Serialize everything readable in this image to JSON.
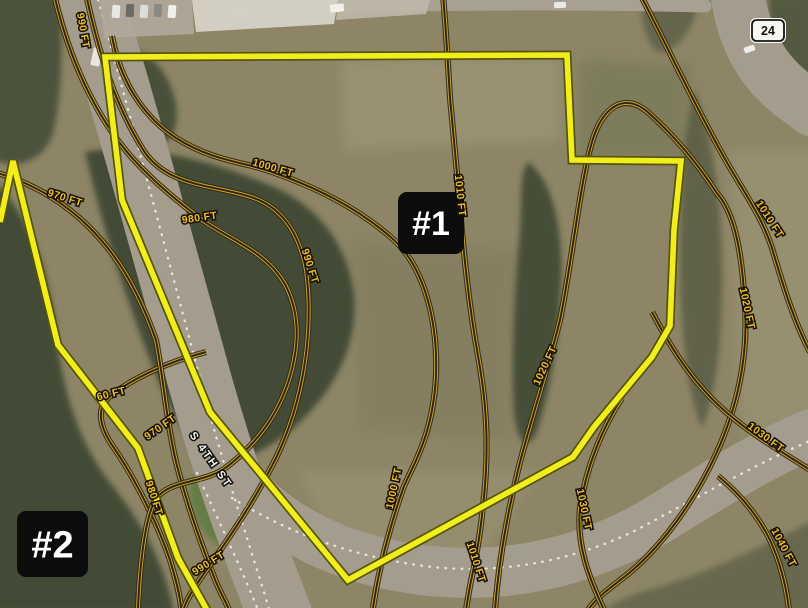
{
  "map": {
    "base_color": "#8d8566",
    "road_color": "#a49d8e",
    "forest_color": "#3e4733",
    "contour_casing_color": "#332a18",
    "contour_core_color": "#cda62e",
    "contour_inner_color": "#2f2713",
    "contour_label_color": "#edbe2a",
    "parcel_under_color": "#55540a",
    "parcel_color": "#f2ee1e",
    "dash_color": "#ece8dd",
    "street_label": {
      "text": "S 4TH ST",
      "x": 208,
      "y": 462,
      "rot": 55
    },
    "route_shield": {
      "label": "24",
      "x": 752,
      "y": 20,
      "w": 32,
      "h": 21
    },
    "badges": [
      {
        "label": "#1",
        "x": 398,
        "y": 192,
        "w": 66,
        "h": 62,
        "fs": 34
      },
      {
        "label": "#2",
        "x": 17,
        "y": 511,
        "w": 71,
        "h": 66,
        "fs": 38
      }
    ],
    "parcels": [
      {
        "id": "parcel-1-boundary",
        "d": "M 105,57 L 567,55 L 572,160 L 681,161 L 674,230 L 670,326 L 652,357 L 594,427 L 573,457 L 348,580 L 210,412 L 122,200 Z"
      },
      {
        "id": "parcel-2-boundary",
        "d": "M 0,222 L 13,161 L 58,345 L 138,448 L 178,558 L 207,610"
      }
    ],
    "roads": [
      {
        "d": "M 88,-12 C 124,105 164,252 200,382 C 230,488 256,552 282,620",
        "w": 64
      },
      {
        "d": "M 228,468 C 278,534 350,562 430,571 C 520,580 600,556 664,516 C 716,484 766,452 814,433",
        "w": 50
      },
      {
        "d": "M 737,-12 C 741,28 756,66 792,94 C 802,101 808,106 814,110",
        "w": 54
      },
      {
        "d": "M 230,10 C 380,4 540,2 705,6",
        "w": 13,
        "c": "#a8a192"
      }
    ],
    "road_dashes": [
      {
        "d": "M 96,-8 C 130,115 168,258 202,386 C 228,482 252,552 270,612"
      },
      {
        "d": "M 232,498 C 290,534 352,556 424,566 C 500,576 580,560 644,526 C 700,496 760,462 812,440"
      },
      {
        "d": "M 197,473 C 218,520 240,565 258,610"
      }
    ],
    "structures": [
      {
        "d": "M 192,0 L 338,0 L 334,24 L 196,32 Z",
        "c": "#d6d2c6",
        "o": 0.95
      },
      {
        "d": "M 338,0 L 430,0 L 426,14 L 336,20 Z",
        "c": "#bdb8a9",
        "o": 0.9
      },
      {
        "d": "M 100,0 L 192,0 L 194,34 L 104,38 Z",
        "c": "#b0aa9b",
        "o": 0.9
      }
    ],
    "vehicles": [
      {
        "x": 112,
        "y": 5,
        "w": 8,
        "h": 13,
        "r": 4,
        "c": "#e8e8e6"
      },
      {
        "x": 126,
        "y": 4,
        "w": 8,
        "h": 13,
        "r": 2,
        "c": "#6a6a66"
      },
      {
        "x": 140,
        "y": 5,
        "w": 8,
        "h": 13,
        "r": 3,
        "c": "#dcdcd8"
      },
      {
        "x": 154,
        "y": 4,
        "w": 8,
        "h": 13,
        "r": 2,
        "c": "#8a8a84"
      },
      {
        "x": 168,
        "y": 5,
        "w": 8,
        "h": 13,
        "r": 4,
        "c": "#efefec"
      },
      {
        "x": 330,
        "y": 4,
        "w": 14,
        "h": 8,
        "r": -6,
        "c": "#f0efe9"
      },
      {
        "x": 554,
        "y": 2,
        "w": 12,
        "h": 6,
        "r": -2,
        "c": "#eceae4"
      },
      {
        "x": 92,
        "y": 48,
        "w": 9,
        "h": 18,
        "r": 12,
        "c": "#e8e6df"
      },
      {
        "x": 744,
        "y": 46,
        "w": 11,
        "h": 6,
        "r": -20,
        "c": "#efefea"
      }
    ],
    "field_patches": [
      {
        "d": "M 340,60 L 560,58 L 560,140 L 345,150 Z",
        "c": "#b3ab8d",
        "o": 0.32
      },
      {
        "d": "M 300,470 L 540,470 L 480,560 L 330,545 Z",
        "c": "#b3ab8d",
        "o": 0.22
      },
      {
        "d": "M 730,150 L 814,150 L 814,430 L 740,430 Z",
        "c": "#b0a98c",
        "o": 0.28
      },
      {
        "d": "M 350,240 L 520,250 L 510,440 L 360,430 Z",
        "c": "#6e6b4e",
        "o": 0.22
      },
      {
        "d": "M 580,60 L 690,64 L 688,160 L 578,158 Z",
        "c": "#6b7350",
        "o": 0.45
      }
    ],
    "forest": [
      {
        "d": "M 85,152 C 140,142 210,160 272,186 C 318,206 348,244 354,296 C 358,344 336,388 298,424 C 268,452 234,466 206,462 C 186,438 166,402 150,360 C 130,308 108,244 96,196 Z",
        "o": 0.92
      },
      {
        "d": "M -6,182 C 28,212 48,268 56,330 C 62,390 78,440 108,480 C 140,520 164,560 174,612 L -6,612 Z",
        "o": 0.92
      },
      {
        "d": "M 528,162 C 552,180 564,228 561,286 C 558,342 550,392 538,428 C 530,452 518,446 514,414 C 511,368 514,298 519,242 C 523,202 518,176 528,162 Z",
        "o": 0.88
      },
      {
        "d": "M -6,-6 L 58,-6 C 64,40 62,90 54,130 C 46,160 20,170 -6,160 Z",
        "o": 0.8
      },
      {
        "d": "M 128,48 C 152,52 170,74 176,104 C 180,132 168,150 146,142 C 128,134 118,106 118,80 C 118,62 120,50 128,48 Z",
        "o": 0.85
      },
      {
        "d": "M 768,-6 L 814,-6 L 814,84 C 794,76 778,52 770,24 Z",
        "o": 0.7
      },
      {
        "d": "M 640,-6 L 700,-6 C 696,24 684,44 664,52 C 650,54 642,32 640,-6 Z",
        "o": 0.5
      },
      {
        "d": "M 694,90 C 712,130 722,200 722,280 C 722,350 714,400 702,428 C 688,396 680,330 680,260 C 680,190 684,130 694,90 Z",
        "o": 0.55
      },
      {
        "d": "M 600,612 L 814,612 L 814,520 C 760,548 700,576 648,590 C 628,596 612,604 600,612 Z",
        "o": 0.45
      },
      {
        "d": "M 196,476 C 220,478 244,492 254,514 C 262,534 252,552 232,550 C 210,546 194,524 190,500 C 188,486 190,478 196,476 Z",
        "c": "#5c7a3f",
        "o": 0.8
      }
    ],
    "contours": [
      {
        "d": "M 206,352 C 168,362 132,378 108,398 C 96,410 100,428 114,448 C 136,480 158,525 170,560 C 176,580 180,595 181,608",
        "labels": [
          {
            "t": "60 FT",
            "x": 112,
            "y": 397,
            "r": -14
          }
        ]
      },
      {
        "d": "M -6,172 C 30,182 62,200 90,228 C 120,258 140,295 156,340 C 164,382 166,418 176,462 C 188,508 204,552 216,582 C 222,596 226,602 229,610",
        "labels": [
          {
            "t": "970 FT",
            "x": 64,
            "y": 201,
            "r": 18
          },
          {
            "t": "970 FT",
            "x": 162,
            "y": 430,
            "r": -35
          }
        ]
      },
      {
        "d": "M 54,-6 C 68,55 94,116 134,160 C 160,188 184,206 202,220 C 228,238 260,250 278,274 C 294,294 300,324 295,354 C 288,398 266,436 228,466 C 204,485 170,478 155,500 C 145,520 140,562 138,608",
        "labels": [
          {
            "t": "980 FT",
            "x": 200,
            "y": 221,
            "r": -8
          },
          {
            "t": "980 FT",
            "x": 151,
            "y": 499,
            "r": 72
          }
        ]
      },
      {
        "d": "M 86,-6 C 98,52 116,106 142,148 C 166,188 214,184 254,198 C 286,210 300,238 306,270 C 314,330 304,400 276,458 C 256,498 232,534 212,562 C 198,582 188,596 184,608",
        "labels": [
          {
            "t": "990 FT",
            "x": 80,
            "y": 31,
            "r": 80
          },
          {
            "t": "990 FT",
            "x": 307,
            "y": 267,
            "r": 72
          },
          {
            "t": "990 FT",
            "x": 210,
            "y": 566,
            "r": -32
          }
        ]
      },
      {
        "d": "M 112,36 C 120,80 142,116 176,138 C 214,162 246,162 272,172 C 312,186 356,206 394,240 C 424,268 438,320 436,376 C 433,430 418,456 404,486 C 392,520 380,560 373,608",
        "labels": [
          {
            "t": "1000 FT",
            "x": 272,
            "y": 171,
            "r": 16
          },
          {
            "t": "1000 FT",
            "x": 397,
            "y": 489,
            "r": -78
          }
        ]
      },
      {
        "d": "M 443,-6 C 446,30 448,64 450,98 C 453,130 456,160 459,196 C 463,246 468,300 478,356 C 486,400 490,446 483,506 C 479,546 474,566 470,586 C 468,598 467,603 466,610",
        "labels": [
          {
            "t": "1010 FT",
            "x": 457,
            "y": 196,
            "r": 84
          },
          {
            "t": "1010 FT",
            "x": 473,
            "y": 563,
            "r": 72
          }
        ]
      },
      {
        "d": "M 588,610 C 596,598 610,588 628,574 C 662,546 694,502 716,454 C 738,406 748,356 745,306 C 742,256 736,214 716,192 C 698,164 676,138 650,114 C 624,90 602,108 592,142 C 580,182 572,262 560,320 C 548,368 534,410 520,462 C 506,518 498,570 495,610",
        "labels": [
          {
            "t": "1020 FT",
            "x": 548,
            "y": 367,
            "r": -65
          },
          {
            "t": "1020 FT",
            "x": 744,
            "y": 309,
            "r": 78
          }
        ]
      },
      {
        "d": "M 640,-6 C 664,40 690,96 720,150 C 744,194 760,212 772,248 C 782,282 794,322 810,352",
        "labels": [
          {
            "t": "1010 FT",
            "x": 767,
            "y": 221,
            "r": 57
          }
        ]
      },
      {
        "d": "M 622,398 C 602,428 586,468 580,508 C 576,546 590,580 604,610",
        "labels": [
          {
            "t": "1030 FT",
            "x": 581,
            "y": 510,
            "r": 78
          }
        ]
      },
      {
        "d": "M 652,312 C 674,354 696,386 726,412 C 754,436 776,448 788,456 C 796,461 804,466 810,470",
        "labels": [
          {
            "t": "1030 FT",
            "x": 764,
            "y": 440,
            "r": 36
          }
        ]
      },
      {
        "d": "M 718,476 C 740,494 758,516 770,540 C 780,562 786,584 789,610",
        "labels": [
          {
            "t": "1040 FT",
            "x": 781,
            "y": 549,
            "r": 62
          }
        ]
      }
    ]
  }
}
